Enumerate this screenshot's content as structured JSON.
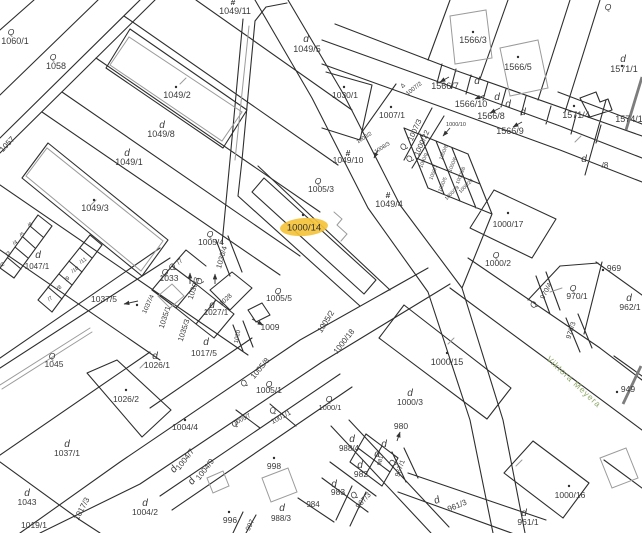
{
  "map": {
    "background": "#ffffff",
    "boundary_color": "#2e2e2e",
    "building_color": "#9b9b9b",
    "text_color": "#3a3a3a",
    "highlight": {
      "label": "1000/14",
      "color": "#F4C33A",
      "x": 304,
      "y": 227,
      "rx": 24,
      "ry": 9
    },
    "street": {
      "name": "Viktora Meyera",
      "color": "#8fa96a",
      "x": 572,
      "y": 384,
      "rot": 43
    },
    "labels": [
      {
        "t": "1049/11",
        "x": 235,
        "y": 14,
        "s": 9
      },
      {
        "t": "1060/1",
        "x": 15,
        "y": 44,
        "s": 9
      },
      {
        "t": "1058",
        "x": 56,
        "y": 69,
        "s": 9
      },
      {
        "t": "1049/5",
        "x": 307,
        "y": 52,
        "s": 9
      },
      {
        "t": "1049/2",
        "x": 177,
        "y": 98,
        "s": 9
      },
      {
        "t": "1049/8",
        "x": 161,
        "y": 137,
        "s": 9
      },
      {
        "t": "1049/1",
        "x": 129,
        "y": 165,
        "s": 9
      },
      {
        "t": "1049/3",
        "x": 95,
        "y": 211,
        "s": 9
      },
      {
        "t": "1057",
        "x": 9,
        "y": 146,
        "s": 8,
        "r": -47
      },
      {
        "t": "1047/1",
        "x": 37,
        "y": 269,
        "s": 8
      },
      {
        "t": "/6",
        "x": 31,
        "y": 226,
        "s": 5.5,
        "r": -35
      },
      {
        "t": "/5",
        "x": 23,
        "y": 236,
        "s": 5.5,
        "r": -35
      },
      {
        "t": "/4",
        "x": 16,
        "y": 244,
        "s": 5.5,
        "r": -35
      },
      {
        "t": "/3",
        "x": 9,
        "y": 255,
        "s": 5.5,
        "r": -35
      },
      {
        "t": "/2",
        "x": 3,
        "y": 266,
        "s": 5.5,
        "r": -35
      },
      {
        "t": "/11",
        "x": 84,
        "y": 262,
        "s": 5.5,
        "r": -35
      },
      {
        "t": "/10",
        "x": 76,
        "y": 271,
        "s": 5.5,
        "r": -35
      },
      {
        "t": "/9",
        "x": 68,
        "y": 280,
        "s": 5.5,
        "r": -35
      },
      {
        "t": "/8",
        "x": 60,
        "y": 289,
        "s": 5.5,
        "r": -35
      },
      {
        "t": "/7",
        "x": 51,
        "y": 300,
        "s": 5.5,
        "r": -35
      },
      {
        "t": "1037/5",
        "x": 104,
        "y": 302,
        "s": 8.5
      },
      {
        "t": "1033",
        "x": 169,
        "y": 281,
        "s": 8.5
      },
      {
        "t": "1030/3",
        "x": 196,
        "y": 289,
        "s": 7.5,
        "r": -72
      },
      {
        "t": "1035/1",
        "x": 167,
        "y": 318,
        "s": 7.5,
        "r": -72
      },
      {
        "t": "1035/3",
        "x": 186,
        "y": 331,
        "s": 7.5,
        "r": -72
      },
      {
        "t": "1037/4",
        "x": 150,
        "y": 305,
        "s": 6.5,
        "r": -65
      },
      {
        "t": "1027/1",
        "x": 216,
        "y": 315,
        "s": 8
      },
      {
        "t": "1028",
        "x": 227,
        "y": 301,
        "s": 6.5,
        "r": -42
      },
      {
        "t": "1017/5",
        "x": 204,
        "y": 356,
        "s": 8.5
      },
      {
        "t": "1010",
        "x": 239,
        "y": 337,
        "s": 6,
        "r": -78
      },
      {
        "t": "1009",
        "x": 270,
        "y": 330,
        "s": 8.5
      },
      {
        "t": "1005/4",
        "x": 211,
        "y": 245,
        "s": 8.5
      },
      {
        "t": "1030/4",
        "x": 224,
        "y": 258,
        "s": 7.5,
        "r": -74
      },
      {
        "t": "/7",
        "x": 181,
        "y": 263,
        "s": 6.5,
        "r": -42
      },
      {
        "t": "1005/3",
        "x": 321,
        "y": 192,
        "s": 8.5
      },
      {
        "t": "1049/4",
        "x": 389,
        "y": 207,
        "s": 9
      },
      {
        "t": "1049/10",
        "x": 348,
        "y": 163,
        "s": 8.5
      },
      {
        "t": "1005/5",
        "x": 279,
        "y": 301,
        "s": 8.5
      },
      {
        "t": "1005/8",
        "x": 262,
        "y": 370,
        "s": 8,
        "r": -50
      },
      {
        "t": "1005/1",
        "x": 269,
        "y": 393,
        "s": 8.5
      },
      {
        "t": "1005/2",
        "x": 328,
        "y": 323,
        "s": 8,
        "r": -58
      },
      {
        "t": "1000/18",
        "x": 346,
        "y": 343,
        "s": 8,
        "r": -52
      },
      {
        "t": "1005/7",
        "x": 243,
        "y": 421,
        "s": 6,
        "r": -28
      },
      {
        "t": "1001/1",
        "x": 282,
        "y": 419,
        "s": 7,
        "r": -28
      },
      {
        "t": "998",
        "x": 274,
        "y": 469,
        "s": 8.5
      },
      {
        "t": "1004/4",
        "x": 185,
        "y": 430,
        "s": 8.5
      },
      {
        "t": "1004/7",
        "x": 187,
        "y": 461,
        "s": 8,
        "r": -52
      },
      {
        "t": "1004/9",
        "x": 207,
        "y": 471,
        "s": 8,
        "r": -52
      },
      {
        "t": "1026/1",
        "x": 157,
        "y": 368,
        "s": 8.5
      },
      {
        "t": "1026/2",
        "x": 126,
        "y": 402,
        "s": 8.5
      },
      {
        "t": "1045",
        "x": 54,
        "y": 367,
        "s": 8.5
      },
      {
        "t": "1037/1",
        "x": 67,
        "y": 456,
        "s": 8.5
      },
      {
        "t": "1043",
        "x": 27,
        "y": 505,
        "s": 8.5
      },
      {
        "t": "1019/1",
        "x": 34,
        "y": 528,
        "s": 8.5
      },
      {
        "t": "1017/3",
        "x": 84,
        "y": 510,
        "s": 8,
        "r": -62
      },
      {
        "t": "1004/2",
        "x": 145,
        "y": 515,
        "s": 8.5
      },
      {
        "t": "996",
        "x": 230,
        "y": 523,
        "s": 8.5
      },
      {
        "t": "997",
        "x": 252,
        "y": 526,
        "s": 7,
        "r": -65
      },
      {
        "t": "988/3",
        "x": 281,
        "y": 521,
        "s": 8
      },
      {
        "t": "984",
        "x": 313,
        "y": 507,
        "s": 8
      },
      {
        "t": "983",
        "x": 338,
        "y": 495,
        "s": 8.5
      },
      {
        "t": "982",
        "x": 361,
        "y": 477,
        "s": 8.5
      },
      {
        "t": "967/3",
        "x": 365,
        "y": 502,
        "s": 7.5,
        "r": -48
      },
      {
        "t": "988/4",
        "x": 349,
        "y": 451,
        "s": 8
      },
      {
        "t": "981",
        "x": 382,
        "y": 461,
        "s": 6,
        "r": -75
      },
      {
        "t": "967/1",
        "x": 402,
        "y": 469,
        "s": 7,
        "r": -70
      },
      {
        "t": "980",
        "x": 401,
        "y": 429,
        "s": 8.5
      },
      {
        "t": "1000/3",
        "x": 410,
        "y": 405,
        "s": 8.5
      },
      {
        "t": "1000/1",
        "x": 330,
        "y": 410,
        "s": 7.5
      },
      {
        "t": "961/3",
        "x": 458,
        "y": 508,
        "s": 8,
        "r": -22
      },
      {
        "t": "961/1",
        "x": 528,
        "y": 525,
        "s": 8.5
      },
      {
        "t": "1000/16",
        "x": 570,
        "y": 498,
        "s": 8.5
      },
      {
        "t": "1000/15",
        "x": 447,
        "y": 365,
        "s": 9
      },
      {
        "t": "1000/17",
        "x": 508,
        "y": 227,
        "s": 8.5
      },
      {
        "t": "1000/2",
        "x": 498,
        "y": 266,
        "s": 8.5
      },
      {
        "t": "969",
        "x": 614,
        "y": 271,
        "s": 8.5
      },
      {
        "t": "962/1",
        "x": 630,
        "y": 310,
        "s": 8.5
      },
      {
        "t": "970/1",
        "x": 577,
        "y": 299,
        "s": 8.5
      },
      {
        "t": "970/4",
        "x": 548,
        "y": 292,
        "s": 7,
        "r": -62
      },
      {
        "t": "970/3",
        "x": 573,
        "y": 331,
        "s": 7,
        "r": -72
      },
      {
        "t": "949",
        "x": 628,
        "y": 392,
        "s": 8.5
      },
      {
        "t": "1566/3",
        "x": 473,
        "y": 43,
        "s": 9
      },
      {
        "t": "1566/5",
        "x": 518,
        "y": 70,
        "s": 9
      },
      {
        "t": "1566/7",
        "x": 445,
        "y": 89,
        "s": 9
      },
      {
        "t": "1566/10",
        "x": 471,
        "y": 107,
        "s": 9
      },
      {
        "t": "1566/8",
        "x": 491,
        "y": 119,
        "s": 9
      },
      {
        "t": "1566/9",
        "x": 510,
        "y": 134,
        "s": 9
      },
      {
        "t": "1571/1",
        "x": 624,
        "y": 72,
        "s": 9
      },
      {
        "t": "1571/4",
        "x": 576,
        "y": 118,
        "s": 9
      },
      {
        "t": "1574/1",
        "x": 629,
        "y": 122,
        "s": 9
      },
      {
        "t": "/8",
        "x": 605,
        "y": 168,
        "s": 8
      },
      {
        "t": "1007/1",
        "x": 392,
        "y": 118,
        "s": 8.5
      },
      {
        "t": "1007/2",
        "x": 415,
        "y": 90,
        "s": 6,
        "r": -38
      },
      {
        "t": "1007/3",
        "x": 417,
        "y": 131,
        "s": 7.5,
        "r": -66
      },
      {
        "t": "1000/22",
        "x": 424,
        "y": 144,
        "s": 7.5,
        "r": -66
      },
      {
        "t": "1030/1",
        "x": 345,
        "y": 98,
        "s": 8.5
      },
      {
        "t": "1000/10",
        "x": 456,
        "y": 126,
        "s": 5.5
      },
      {
        "t": "1000/9",
        "x": 425,
        "y": 161,
        "s": 5,
        "r": -68
      },
      {
        "t": "1000/8",
        "x": 445,
        "y": 153,
        "s": 5,
        "r": -68
      },
      {
        "t": "1000/7",
        "x": 435,
        "y": 173,
        "s": 5,
        "r": -68
      },
      {
        "t": "1000/6",
        "x": 454,
        "y": 165,
        "s": 5,
        "r": -68
      },
      {
        "t": "1000/5",
        "x": 444,
        "y": 185,
        "s": 5,
        "r": -68
      },
      {
        "t": "1000/26",
        "x": 462,
        "y": 176,
        "s": 5,
        "r": -68
      },
      {
        "t": "1000/29",
        "x": 453,
        "y": 194,
        "s": 5,
        "r": -45
      },
      {
        "t": "1000/28",
        "x": 467,
        "y": 187,
        "s": 5,
        "r": -45
      },
      {
        "t": "1008/2",
        "x": 365,
        "y": 139,
        "s": 5.5,
        "r": -32
      },
      {
        "t": "1008/3",
        "x": 383,
        "y": 149,
        "s": 5.5,
        "r": -32
      }
    ],
    "symbols": [
      {
        "g": "d",
        "x": 306,
        "y": 42
      },
      {
        "g": "d",
        "x": 162,
        "y": 128
      },
      {
        "g": "d",
        "x": 127,
        "y": 156
      },
      {
        "g": "d",
        "x": 38,
        "y": 258
      },
      {
        "g": "d",
        "x": 212,
        "y": 308
      },
      {
        "g": "d",
        "x": 206,
        "y": 345
      },
      {
        "g": "d",
        "x": 155,
        "y": 359
      },
      {
        "g": "d",
        "x": 67,
        "y": 447
      },
      {
        "g": "d",
        "x": 27,
        "y": 496
      },
      {
        "g": "d",
        "x": 145,
        "y": 506
      },
      {
        "g": "d",
        "x": 282,
        "y": 511
      },
      {
        "g": "d",
        "x": 334,
        "y": 487
      },
      {
        "g": "d",
        "x": 360,
        "y": 468
      },
      {
        "g": "d",
        "x": 352,
        "y": 442
      },
      {
        "g": "d",
        "x": 384,
        "y": 447
      },
      {
        "g": "d",
        "x": 377,
        "y": 457
      },
      {
        "g": "d",
        "x": 410,
        "y": 396
      },
      {
        "g": "d",
        "x": 524,
        "y": 516
      },
      {
        "g": "d",
        "x": 629,
        "y": 301
      },
      {
        "g": "d",
        "x": 623,
        "y": 62
      },
      {
        "g": "d",
        "x": 584,
        "y": 162
      },
      {
        "g": "d",
        "x": 477,
        "y": 84
      },
      {
        "g": "d",
        "x": 497,
        "y": 100
      },
      {
        "g": "d",
        "x": 508,
        "y": 107
      },
      {
        "g": "d",
        "x": 523,
        "y": 115
      },
      {
        "g": "d",
        "x": 438,
        "y": 503,
        "r": -22
      },
      {
        "g": "d",
        "x": 176,
        "y": 471,
        "r": -52
      },
      {
        "g": "d",
        "x": 194,
        "y": 483,
        "r": -52
      },
      {
        "g": "q",
        "x": 11,
        "y": 35
      },
      {
        "g": "q",
        "x": 53,
        "y": 60
      },
      {
        "g": "q",
        "x": 318,
        "y": 184
      },
      {
        "g": "q",
        "x": 210,
        "y": 237
      },
      {
        "g": "q",
        "x": 165,
        "y": 275
      },
      {
        "g": "q",
        "x": 278,
        "y": 294
      },
      {
        "g": "q",
        "x": 52,
        "y": 359
      },
      {
        "g": "q",
        "x": 246,
        "y": 385,
        "r": -50
      },
      {
        "g": "q",
        "x": 269,
        "y": 387
      },
      {
        "g": "q",
        "x": 274,
        "y": 413,
        "r": -28
      },
      {
        "g": "q",
        "x": 329,
        "y": 402
      },
      {
        "g": "q",
        "x": 496,
        "y": 258
      },
      {
        "g": "q",
        "x": 573,
        "y": 291
      },
      {
        "g": "q",
        "x": 536,
        "y": 306,
        "r": -62
      },
      {
        "g": "q",
        "x": 395,
        "y": 464,
        "r": -70
      },
      {
        "g": "q",
        "x": 356,
        "y": 497,
        "r": -48
      },
      {
        "g": "q",
        "x": 174,
        "y": 269,
        "r": -42
      },
      {
        "g": "q",
        "x": 202,
        "y": 282,
        "r": -72
      },
      {
        "g": "q",
        "x": 406,
        "y": 148,
        "r": -66
      },
      {
        "g": "q",
        "x": 412,
        "y": 160,
        "r": -66
      },
      {
        "g": "q",
        "x": 608,
        "y": 10
      },
      {
        "g": "q",
        "x": 236,
        "y": 426,
        "r": -28
      },
      {
        "g": "#",
        "x": 233,
        "y": 5
      },
      {
        "g": "#",
        "x": 348,
        "y": 156
      },
      {
        "g": "#",
        "x": 388,
        "y": 198
      },
      {
        "g": "t",
        "x": 404,
        "y": 87,
        "r": -38
      }
    ],
    "dots": [
      [
        176,
        87
      ],
      [
        94,
        200
      ],
      [
        126,
        390
      ],
      [
        303,
        215
      ],
      [
        391,
        107
      ],
      [
        344,
        87
      ],
      [
        473,
        32
      ],
      [
        518,
        57
      ],
      [
        574,
        106
      ],
      [
        508,
        213
      ],
      [
        447,
        353
      ],
      [
        569,
        486
      ],
      [
        274,
        458
      ],
      [
        229,
        512
      ],
      [
        603,
        270
      ],
      [
        617,
        392
      ],
      [
        185,
        420
      ],
      [
        137,
        305
      ],
      [
        622,
        66
      ]
    ],
    "arrows": [
      [
        449,
        77,
        440,
        82
      ],
      [
        485,
        95,
        475,
        99
      ],
      [
        500,
        108,
        490,
        113
      ],
      [
        522,
        122,
        513,
        127
      ],
      [
        450,
        128,
        443,
        136
      ],
      [
        138,
        301,
        124,
        304
      ],
      [
        252,
        319,
        263,
        325
      ],
      [
        190,
        284,
        190,
        273
      ],
      [
        215,
        284,
        215,
        274
      ],
      [
        397,
        441,
        400,
        432
      ],
      [
        378,
        150,
        374,
        158
      ]
    ]
  }
}
